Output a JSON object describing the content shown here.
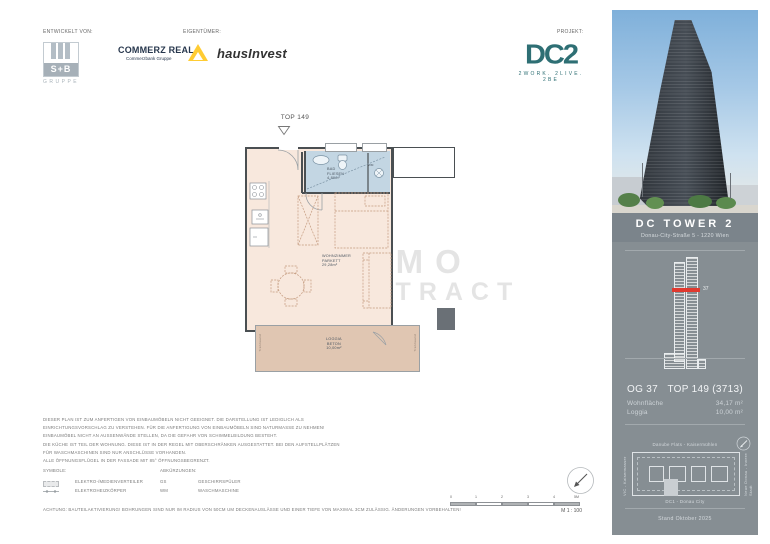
{
  "header": {
    "developed_by_label": "ENTWICKELT VON:",
    "owner_label": "EIGENTÜMER:",
    "project_label": "PROJEKT:",
    "sb_gruppe": {
      "name": "S+B",
      "subtitle": "GRUPPE"
    },
    "commerz_real": {
      "name": "COMMERZ REAL",
      "subtitle": "Commerzbank Gruppe"
    },
    "hausinvest": "hausInvest",
    "dc2": {
      "name": "DC2",
      "tagline": "2WORK. 2LIVE. 2BE"
    }
  },
  "floorplan": {
    "unit_label": "TOP 149",
    "entrance_marker_icon": "triangle-down-icon",
    "rooms": {
      "bad": {
        "name": "BAD",
        "finish": "FLIESEN",
        "area": "4,89m²"
      },
      "wohnen": {
        "name": "WOHNZIMMER",
        "finish": "PARKETT",
        "area": "29,28m²"
      },
      "loggia": {
        "name": "LOGGIA",
        "finish": "BETON",
        "area": "10,00m²"
      }
    },
    "marks": {
      "gs": "GS",
      "wm": "WM",
      "trennwand_left": "Trennwand",
      "trennwand_right": "Trennwand"
    },
    "watermark": {
      "line1": "IMMO",
      "line2": "CONTRACT"
    }
  },
  "notes": {
    "disclaimer_lines": [
      "DIESER PLAN IST ZUM ANFERTIGEN VON EINBAUMÖBELN NICHT GEEIGNET. DIE DARSTELLUNG IST LEDIGLICH ALS",
      "EINRICHTUNGSVORSCHLAG ZU VERSTEHEN. FÜR DIE ANFERTIGUNG VON EINBAUMÖBELN SIND NATURMASSE ZU NEHMEN!",
      "EINBAUMÖBEL NICHT AN AUSSENWÄNDE STELLEN, DA DIE GEFAHR VON SCHIMMELBILDUNG BESTEHT.",
      "DIE KÜCHE IST TEIL DER WOHNUNG. DIESE IST IN DER REGEL MIT OBERSCHRÄNKEN AUSGESTATTET. BEI DEN AUFSTELLPLÄTZEN",
      "FÜR WASCHMASCHINEN SIND NUR ANSCHLÜSSE VORHANDEN.",
      "ALLE ÖFFNUNGSFLÜGEL IN DER FASSADE MIT 85° ÖFFNUNGSBEGRENZT."
    ],
    "symbols_label": "SYMBOLE:",
    "abbreviations_label": "ABKÜRZUNGEN:",
    "symbols": [
      {
        "label": "ELEKTRO-/MEDIENVERTEILER"
      },
      {
        "label": "ELEKTROHEIZKÖRPER"
      }
    ],
    "abbreviations": [
      {
        "abbr": "GS",
        "label": "GESCHIRRSPÜLER"
      },
      {
        "abbr": "WM",
        "label": "WASCHMASCHINE"
      }
    ],
    "warning": "ACHTUNG: BAUTEILAKTIVIERUNG! BOHRUNGEN SIND NUR IM RADIUS VON 50CM UM DECKENAUSLÄSSE UND EINER TIEFE VON MAXIMAL 3CM ZULÄSSIG. ÄNDERUNGEN VORBEHALTEN!"
  },
  "scalebar": {
    "ticks": [
      "0",
      "1",
      "2",
      "3",
      "4",
      "5M"
    ],
    "scale_label": "M 1 : 100",
    "north_icon": "north-arrow-icon"
  },
  "sidebar": {
    "building_name": "DC TOWER 2",
    "address": "Donau-City-Straße 5 - 1220 Wien",
    "elevation": {
      "floor_marker": "37",
      "marker_color": "#e0392f"
    },
    "floor_label": "OG 37",
    "unit_label": "TOP 149 (3713)",
    "rows": [
      {
        "label": "Wohnfläche",
        "value": "34,17 m²"
      },
      {
        "label": "Loggia",
        "value": "10,00 m²"
      }
    ],
    "siteplan": {
      "north_label": "Danube Flats - Kaisermühlen",
      "west_label": "VIC - Kaiserwasser",
      "east_label": "Neue Donau - Innere Stadt",
      "south_label": "DC1 - Donau City",
      "compass_icon": "north-arrow-icon"
    },
    "date": "Stand Oktober 2025"
  },
  "colors": {
    "dc2_teal": "#2e6f74",
    "commerz_yellow": "#ffcc33",
    "floor_peach": "#f8e8dd",
    "bath_blue": "#c3d6e3",
    "loggia_tan": "#e0c6b2",
    "panel_gray": "#868e93",
    "floor_marker_red": "#e0392f"
  }
}
